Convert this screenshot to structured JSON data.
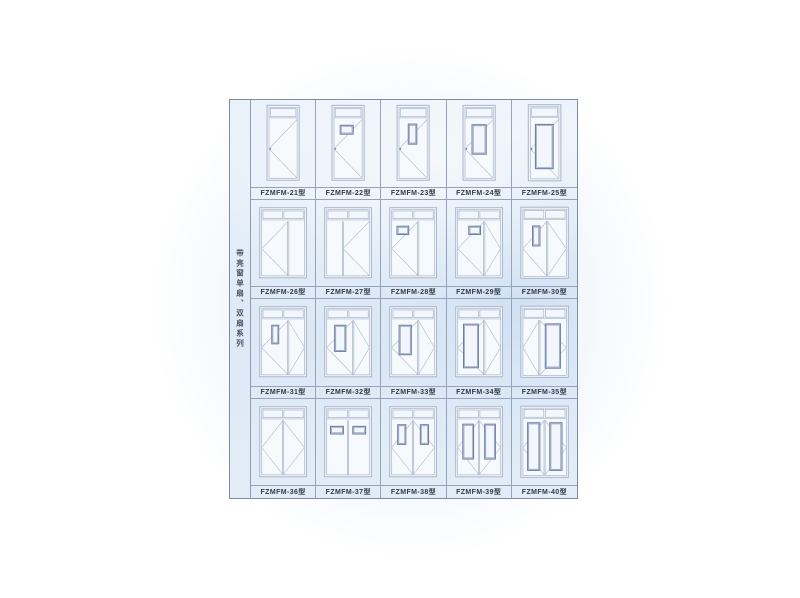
{
  "series": {
    "title": "带亮窗单扇、双扇系列"
  },
  "colors": {
    "line": "#a6b2c9",
    "swing": "#b6c1d4",
    "panel": "#6d7ea2",
    "doorFill": "#f6fafd",
    "paneFill": "#f1f7fc"
  },
  "catalog": {
    "cells": [
      {
        "label": "FZMFM-21型",
        "diagram": {
          "door": "single",
          "transom": 1,
          "leaves": [
            {
              "w": 1,
              "swing": "left"
            }
          ]
        }
      },
      {
        "label": "FZMFM-22型",
        "diagram": {
          "door": "single",
          "transom": 1,
          "leaves": [
            {
              "w": 1,
              "swing": "left",
              "panel": {
                "x": 0.22,
                "y": 0.1,
                "w": 0.46,
                "h": 0.15
              }
            }
          ]
        }
      },
      {
        "label": "FZMFM-23型",
        "diagram": {
          "door": "single",
          "transom": 1,
          "leaves": [
            {
              "w": 1,
              "swing": "left",
              "panel": {
                "x": 0.33,
                "y": 0.08,
                "w": 0.3,
                "h": 0.34
              }
            }
          ]
        }
      },
      {
        "label": "FZMFM-24型",
        "diagram": {
          "door": "single",
          "transom": 1,
          "leaves": [
            {
              "w": 1,
              "swing": "left",
              "panel": {
                "x": 0.25,
                "y": 0.09,
                "w": 0.5,
                "h": 0.5
              }
            }
          ]
        }
      },
      {
        "label": "FZMFM-25型",
        "diagram": {
          "door": "single",
          "transom": 1,
          "leaves": [
            {
              "w": 1,
              "swing": "left",
              "panel": {
                "x": 0.18,
                "y": 0.09,
                "w": 0.62,
                "h": 0.74
              }
            }
          ]
        }
      },
      {
        "label": "FZMFM-26型",
        "diagram": {
          "door": "double",
          "transom": 2,
          "leaves": [
            {
              "w": 0.62,
              "swing": "left"
            },
            {
              "w": 0.38
            }
          ]
        }
      },
      {
        "label": "FZMFM-27型",
        "diagram": {
          "door": "double",
          "transom": 2,
          "leaves": [
            {
              "w": 0.38
            },
            {
              "w": 0.62,
              "swing": "left"
            }
          ]
        }
      },
      {
        "label": "FZMFM-28型",
        "diagram": {
          "door": "double",
          "transom": 2,
          "leaves": [
            {
              "w": 0.62,
              "swing": "left",
              "panel": {
                "x": 0.2,
                "y": 0.09,
                "w": 0.44,
                "h": 0.15
              }
            },
            {
              "w": 0.38
            }
          ]
        }
      },
      {
        "label": "FZMFM-29型",
        "diagram": {
          "door": "double",
          "transom": 2,
          "leaves": [
            {
              "w": 0.62,
              "swing": "left",
              "panel": {
                "x": 0.42,
                "y": 0.09,
                "w": 0.44,
                "h": 0.15
              }
            },
            {
              "w": 0.38,
              "swing": "right"
            }
          ]
        }
      },
      {
        "label": "FZMFM-30型",
        "diagram": {
          "door": "double",
          "transom": 2,
          "leaves": [
            {
              "w": 0.56,
              "swing": "left",
              "panel": {
                "x": 0.4,
                "y": 0.09,
                "w": 0.3,
                "h": 0.36
              }
            },
            {
              "w": 0.44,
              "swing": "right"
            }
          ]
        }
      },
      {
        "label": "FZMFM-31型",
        "diagram": {
          "door": "double",
          "transom": 2,
          "leaves": [
            {
              "w": 0.62,
              "swing": "left",
              "panel": {
                "x": 0.38,
                "y": 0.09,
                "w": 0.26,
                "h": 0.34
              }
            },
            {
              "w": 0.38,
              "swing": "right"
            }
          ]
        }
      },
      {
        "label": "FZMFM-32型",
        "diagram": {
          "door": "double",
          "transom": 2,
          "leaves": [
            {
              "w": 0.62,
              "swing": "left",
              "panel": {
                "x": 0.3,
                "y": 0.09,
                "w": 0.42,
                "h": 0.48
              }
            },
            {
              "w": 0.38,
              "swing": "right"
            }
          ]
        }
      },
      {
        "label": "FZMFM-33型",
        "diagram": {
          "door": "double",
          "transom": 2,
          "leaves": [
            {
              "w": 0.62,
              "swing": "left",
              "panel": {
                "x": 0.28,
                "y": 0.09,
                "w": 0.46,
                "h": 0.54
              }
            },
            {
              "w": 0.38,
              "swing": "right"
            }
          ]
        }
      },
      {
        "label": "FZMFM-34型",
        "diagram": {
          "door": "double",
          "transom": 2,
          "leaves": [
            {
              "w": 0.62,
              "swing": "left",
              "panel": {
                "x": 0.22,
                "y": 0.07,
                "w": 0.56,
                "h": 0.8
              }
            },
            {
              "w": 0.38,
              "swing": "right"
            }
          ]
        }
      },
      {
        "label": "FZMFM-35型",
        "diagram": {
          "door": "double",
          "transom": 2,
          "leaves": [
            {
              "w": 0.38,
              "swing": "left"
            },
            {
              "w": 0.62,
              "swing": "right",
              "panel": {
                "x": 0.22,
                "y": 0.07,
                "w": 0.56,
                "h": 0.8
              }
            }
          ]
        }
      },
      {
        "label": "FZMFM-36型",
        "diagram": {
          "door": "double",
          "transom": 2,
          "leaves": [
            {
              "w": 0.5,
              "swing": "left"
            },
            {
              "w": 0.5,
              "swing": "right"
            }
          ]
        }
      },
      {
        "label": "FZMFM-37型",
        "diagram": {
          "door": "double",
          "transom": 2,
          "leaves": [
            {
              "w": 0.5,
              "panel": {
                "x": 0.18,
                "y": 0.11,
                "w": 0.6,
                "h": 0.14
              }
            },
            {
              "w": 0.5,
              "panel": {
                "x": 0.22,
                "y": 0.11,
                "w": 0.6,
                "h": 0.14
              }
            }
          ]
        }
      },
      {
        "label": "FZMFM-38型",
        "diagram": {
          "door": "double",
          "transom": 2,
          "leaves": [
            {
              "w": 0.5,
              "swing": "left",
              "panel": {
                "x": 0.28,
                "y": 0.08,
                "w": 0.38,
                "h": 0.36
              }
            },
            {
              "w": 0.5,
              "swing": "right",
              "panel": {
                "x": 0.34,
                "y": 0.08,
                "w": 0.38,
                "h": 0.36
              }
            }
          ]
        }
      },
      {
        "label": "FZMFM-39型",
        "diagram": {
          "door": "double",
          "transom": 2,
          "leaves": [
            {
              "w": 0.5,
              "swing": "left",
              "panel": {
                "x": 0.24,
                "y": 0.07,
                "w": 0.5,
                "h": 0.64
              }
            },
            {
              "w": 0.5,
              "swing": "right",
              "panel": {
                "x": 0.26,
                "y": 0.07,
                "w": 0.5,
                "h": 0.64
              }
            }
          ]
        }
      },
      {
        "label": "FZMFM-40型",
        "diagram": {
          "door": "double",
          "transom": 2,
          "leaves": [
            {
              "w": 0.5,
              "swing": "left",
              "panel": {
                "x": 0.22,
                "y": 0.05,
                "w": 0.56,
                "h": 0.86
              }
            },
            {
              "w": 0.5,
              "swing": "right",
              "panel": {
                "x": 0.24,
                "y": 0.05,
                "w": 0.56,
                "h": 0.86
              }
            }
          ]
        }
      }
    ]
  }
}
